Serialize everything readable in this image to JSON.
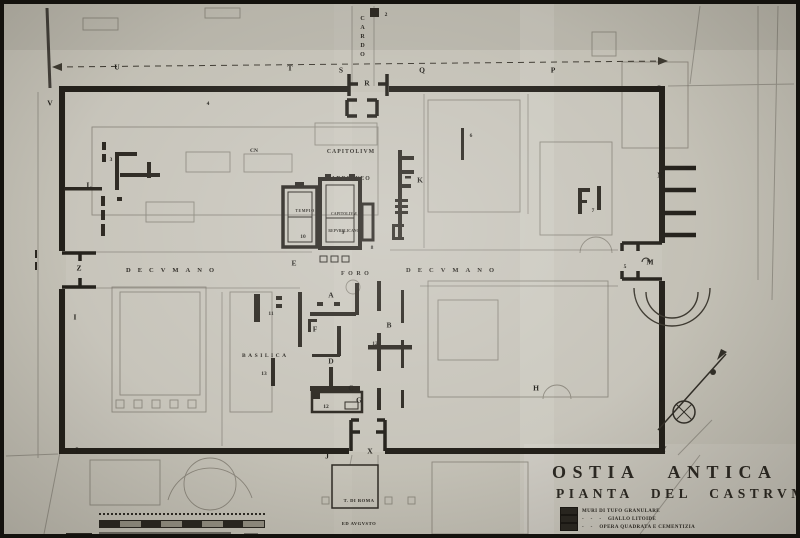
{
  "title": {
    "line1": "OSTIA ANTICA",
    "line2": "PIANTA DEL CASTRVM"
  },
  "legend": {
    "items": [
      {
        "text": "MURI DI TUFO GRANULARE"
      },
      {
        "text": "-    -    -    GIALLO LITOIDE"
      },
      {
        "text": "-    -    OPERA QUADRATA E CEMENTIZIA"
      }
    ],
    "swatch_color": "#26231d"
  },
  "streets": {
    "cardo": "CARDO",
    "decumano_west": "DECVMANO",
    "decumano_east": "DECVMANO",
    "foro": "FORO"
  },
  "buildings": {
    "capitolium_adrianeo_line1": "CAPITOLIVM",
    "capitolium_adrianeo_line2": "ADRIANEO",
    "tempio": "TEMPIO",
    "capitolium_repubblicano_line1": "CAPITOLIVM",
    "capitolium_repubblicano_line2": "REPVBBLICANO",
    "basilica": "BASILICA",
    "tempio_roma_line1": "T. DI ROMA",
    "tempio_roma_line2": "ED AVGVSTO"
  },
  "markers": [
    {
      "t": "V",
      "x": 46,
      "y": 99,
      "kind": "letter"
    },
    {
      "t": "U",
      "x": 113,
      "y": 63,
      "kind": "letter"
    },
    {
      "t": "T",
      "x": 286,
      "y": 64,
      "kind": "letter"
    },
    {
      "t": "S",
      "x": 337,
      "y": 66,
      "kind": "letter"
    },
    {
      "t": "R",
      "x": 363,
      "y": 79,
      "kind": "letter"
    },
    {
      "t": "Q",
      "x": 418,
      "y": 66,
      "kind": "letter"
    },
    {
      "t": "P",
      "x": 549,
      "y": 66,
      "kind": "letter"
    },
    {
      "t": "O",
      "x": 655,
      "y": 84,
      "kind": "letter"
    },
    {
      "t": "N",
      "x": 656,
      "y": 171,
      "kind": "letter"
    },
    {
      "t": "M",
      "x": 646,
      "y": 258,
      "kind": "letter"
    },
    {
      "t": "L",
      "x": 85,
      "y": 181,
      "kind": "letter"
    },
    {
      "t": "Z",
      "x": 75,
      "y": 264,
      "kind": "letter"
    },
    {
      "t": "I",
      "x": 71,
      "y": 313,
      "kind": "letter"
    },
    {
      "t": "L",
      "x": 74,
      "y": 446,
      "kind": "letter"
    },
    {
      "t": "J",
      "x": 323,
      "y": 452,
      "kind": "letter"
    },
    {
      "t": "X",
      "x": 366,
      "y": 447,
      "kind": "letter"
    },
    {
      "t": "Y",
      "x": 660,
      "y": 445,
      "kind": "letter"
    },
    {
      "t": "K",
      "x": 416,
      "y": 176,
      "kind": "letter"
    },
    {
      "t": "H",
      "x": 532,
      "y": 384,
      "kind": "letter"
    },
    {
      "t": "E",
      "x": 290,
      "y": 259,
      "kind": "letter"
    },
    {
      "t": "A",
      "x": 327,
      "y": 291,
      "kind": "letter"
    },
    {
      "t": "F",
      "x": 311,
      "y": 325,
      "kind": "letter"
    },
    {
      "t": "B",
      "x": 385,
      "y": 321,
      "kind": "letter"
    },
    {
      "t": "D",
      "x": 327,
      "y": 357,
      "kind": "letter"
    },
    {
      "t": "C",
      "x": 347,
      "y": 384,
      "kind": "letter"
    },
    {
      "t": "G",
      "x": 355,
      "y": 396,
      "kind": "letter"
    },
    {
      "t": "▼",
      "x": 657,
      "y": 397,
      "kind": "triangle"
    },
    {
      "t": "2",
      "x": 382,
      "y": 11,
      "kind": "number"
    },
    {
      "t": "3",
      "x": 107,
      "y": 156,
      "kind": "number"
    },
    {
      "t": "4",
      "x": 204,
      "y": 100,
      "kind": "number"
    },
    {
      "t": "CN",
      "x": 250,
      "y": 147,
      "kind": "number"
    },
    {
      "t": "5",
      "x": 621,
      "y": 263,
      "kind": "number"
    },
    {
      "t": "6",
      "x": 467,
      "y": 132,
      "kind": "number"
    },
    {
      "t": "7",
      "x": 589,
      "y": 207,
      "kind": "number"
    },
    {
      "t": "8",
      "x": 368,
      "y": 244,
      "kind": "number"
    },
    {
      "t": "9",
      "x": 339,
      "y": 229,
      "kind": "number"
    },
    {
      "t": "10",
      "x": 299,
      "y": 233,
      "kind": "number"
    },
    {
      "t": "11",
      "x": 267,
      "y": 310,
      "kind": "number"
    },
    {
      "t": "12",
      "x": 371,
      "y": 340,
      "kind": "number"
    },
    {
      "t": "13",
      "x": 260,
      "y": 370,
      "kind": "number"
    },
    {
      "t": "12",
      "x": 322,
      "y": 403,
      "kind": "number"
    }
  ]
}
